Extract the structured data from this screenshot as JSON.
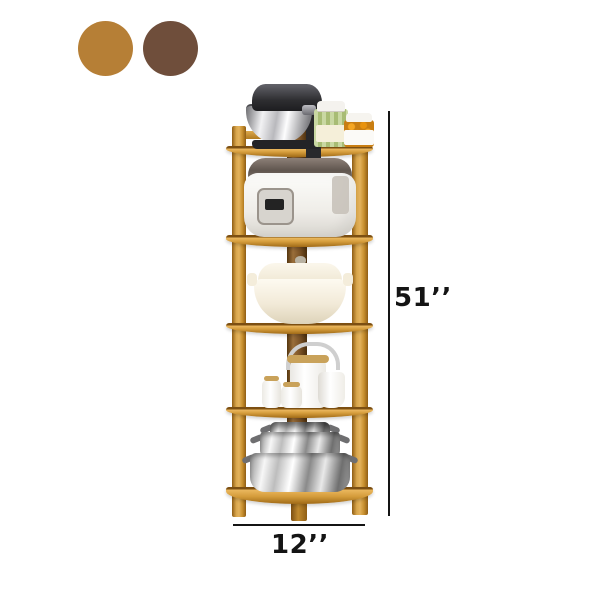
{
  "page": {
    "background": "#ffffff"
  },
  "color_options": {
    "swatches": [
      {
        "name": "natural-wood",
        "color": "#b67f36"
      },
      {
        "name": "walnut-brown",
        "color": "#6f4e3b"
      }
    ]
  },
  "dimensions": {
    "height_label": "51’’",
    "width_label": "12’’",
    "line_color": "#141414"
  },
  "product": {
    "name": "5-tier wooden corner shelf with kitchen items",
    "frame": {
      "wood_light": "#eab75e",
      "wood_mid": "#cf9737",
      "wood_dark": "#a06a17",
      "corner_post": "#7a5226"
    },
    "tiers": [
      {
        "level": 1,
        "items": [
          "stand-mixer",
          "glass-jar-pickles",
          "jar-preserves"
        ]
      },
      {
        "level": 2,
        "items": [
          "rice-cooker"
        ]
      },
      {
        "level": 3,
        "items": [
          "ceramic-casserole"
        ]
      },
      {
        "level": 4,
        "items": [
          "teapot",
          "milk-jug",
          "sugar-jar",
          "cup"
        ]
      },
      {
        "level": 5,
        "items": [
          "stainless-pot-stack"
        ]
      }
    ]
  }
}
